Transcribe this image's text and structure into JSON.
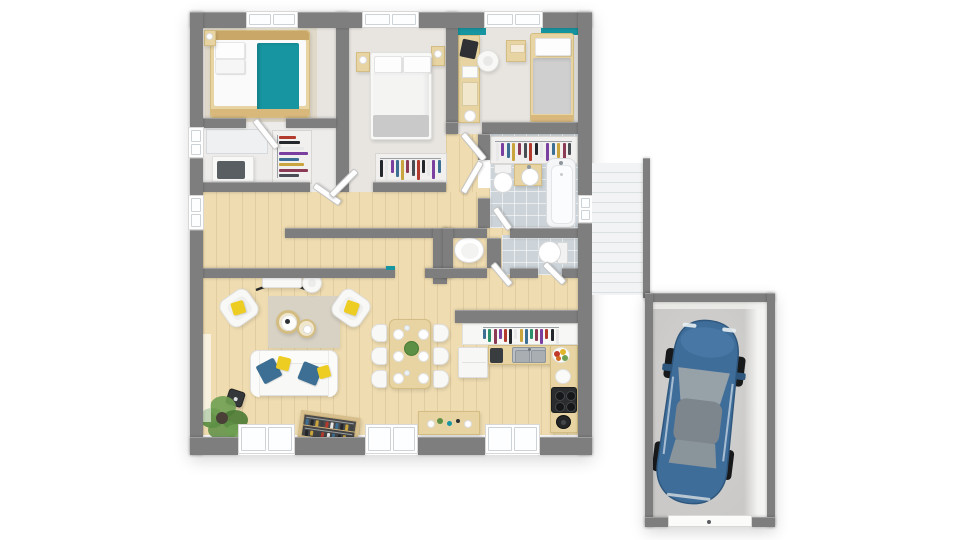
{
  "scene": {
    "type": "3d-floor-plan-top-view",
    "background": "#ffffff",
    "rooms": [
      {
        "name": "bedroom-1",
        "floor": "carpet",
        "furniture": [
          "double-bed",
          "teal-bed-runner",
          "pillows",
          "nightstand",
          "bedside-lamp",
          "bed-rug"
        ]
      },
      {
        "name": "dressing-room",
        "floor": "carpet",
        "furniture": [
          "open-wardrobe",
          "hanging-clothes",
          "dresser",
          "mirror-cabinet"
        ]
      },
      {
        "name": "bedroom-2",
        "floor": "carpet",
        "furniture": [
          "double-bed",
          "pillows",
          "gray-throw",
          "nightstand-left",
          "nightstand-right",
          "bedside-lamps",
          "open-closet",
          "hanging-clothes"
        ]
      },
      {
        "name": "bedroom-3",
        "floor": "carpet",
        "accent_wall": "teal",
        "furniture": [
          "desk",
          "laptop",
          "office-chair",
          "single-bed",
          "nightstand"
        ]
      },
      {
        "name": "bathroom",
        "floor": "tile",
        "furniture": [
          "open-closet",
          "hanging-clothes",
          "toilet",
          "vanity-sink",
          "bathtub"
        ]
      },
      {
        "name": "wc-1",
        "floor": "wood",
        "furniture": [
          "toilet"
        ]
      },
      {
        "name": "wc-2",
        "floor": "tile",
        "furniture": [
          "toilet"
        ]
      },
      {
        "name": "hallway",
        "floor": "wood",
        "furniture": []
      },
      {
        "name": "living-room",
        "floor": "wood",
        "furniture": [
          "sofa",
          "armchair",
          "armchair",
          "coffee-table",
          "coffee-table",
          "area-rug",
          "console-table-x-legs",
          "stool",
          "wood-stove",
          "potted-plant",
          "low-bookshelf"
        ]
      },
      {
        "name": "dining-area",
        "floor": "wood",
        "furniture": [
          "dining-table",
          "six-chairs",
          "plates",
          "glasses",
          "centerpiece-plant",
          "sideboard"
        ]
      },
      {
        "name": "kitchen",
        "floor": "wood",
        "furniture": [
          "wall-shelf",
          "jars",
          "fridge",
          "coffee-machine",
          "double-sink",
          "fruit-bowl",
          "bowl",
          "cooktop",
          "kettle"
        ]
      },
      {
        "name": "staircase",
        "floor": "stairs",
        "furniture": []
      },
      {
        "name": "garage",
        "floor": "concrete",
        "furniture": [
          "car",
          "garage-door"
        ]
      }
    ],
    "car": {
      "color_name": "blue"
    },
    "palette": {
      "wall": "#7e7e7e",
      "wood": "#efdcb1",
      "woodLine": "rgba(130,95,45,0.12)",
      "carpet": "#e8e5e1",
      "carpet2": "#edecea",
      "tile": "#ccd4d9",
      "grout": "rgba(255,255,255,0.55)",
      "teal": "#1795a0",
      "yellow": "#eecd23",
      "pillowBlue": "#3c6f93",
      "rug": "#d8d2c5",
      "bedRug": "#e0d9ca",
      "furnWhite": "#f8f8f7",
      "furnBorder": "#e0e0de",
      "woodFurn": "#e7d4a2",
      "woodFurnBorder": "#d3bd82",
      "grayThrow": "#c9c9c9",
      "dark": "#2e3134",
      "stair": "#f1f3f4",
      "stairLine": "#dadfe1",
      "garageFloor": "#cac9c7",
      "garageFloorLight": "#d4d3d1",
      "carBlue": "#3e6d9a",
      "carBlueDark": "#2f577d",
      "carBlueLight": "#4d7ba8",
      "glass": "#97a1a8",
      "roof": "#7e868d",
      "green": "#5d8f45",
      "greenDark": "#4a7a34",
      "greenLight": "#6fa052",
      "steel": "#b9bfc4",
      "steelDark": "#8f969b",
      "fruitRed": "#c0392b",
      "fruitYellow": "#e3b52a",
      "fruitGreen": "#6fa052",
      "fruitOrange": "#d2691e"
    },
    "clothes_colors": [
      "#b23b2e",
      "#23262b",
      "#e8e8e8",
      "#7b3fa0",
      "#3c6f93",
      "#caa53d",
      "#8c3b57",
      "#4a4f55"
    ],
    "jar_colors": [
      "#7b3fa0",
      "#b23b2e",
      "#23262b",
      "#e8e8e8",
      "#caa53d",
      "#3c6f93",
      "#2a8f6a",
      "#8c3b57"
    ],
    "book_colors": [
      "#3f4245",
      "#b23b2e",
      "#e8e8e8",
      "#3c6f93",
      "#23262b",
      "#caa53d"
    ]
  }
}
